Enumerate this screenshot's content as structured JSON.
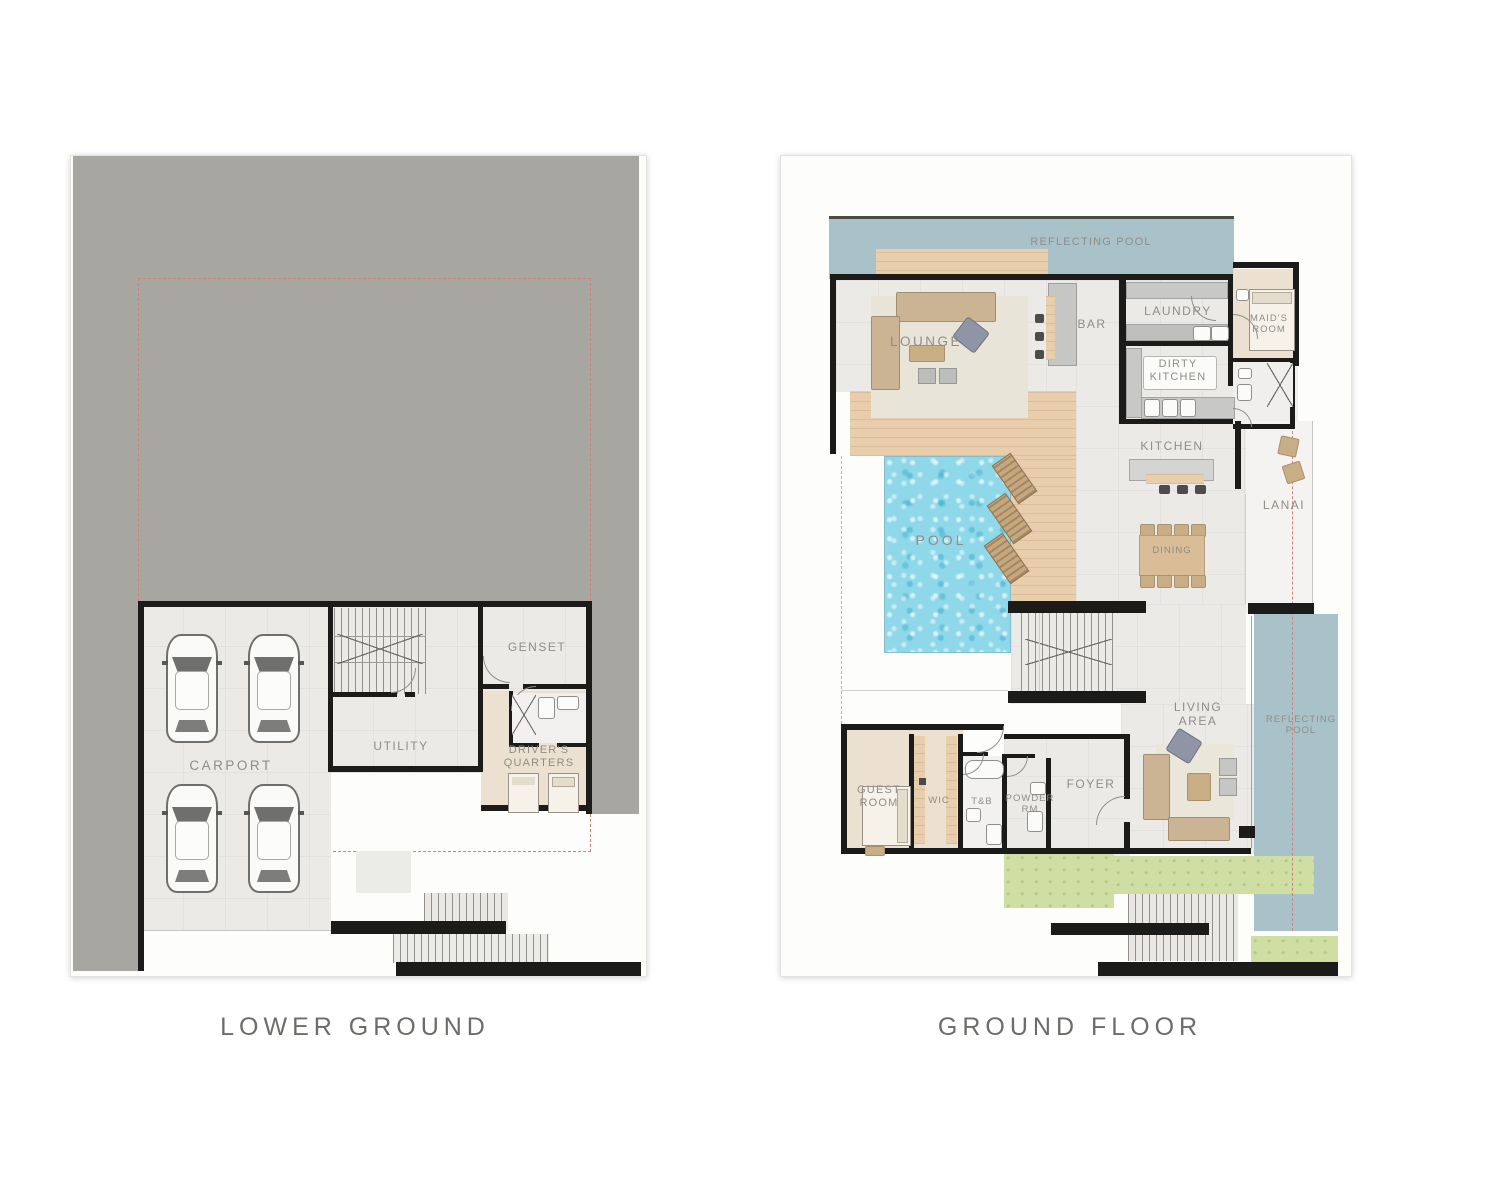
{
  "left_plan": {
    "title": "LOWER GROUND",
    "labels": {
      "carport": "CARPORT",
      "utility": "UTILITY",
      "genset": "GENSET",
      "drivers_quarters": [
        "DRIVER'S",
        "QUARTERS"
      ]
    }
  },
  "right_plan": {
    "title": "GROUND FLOOR",
    "labels": {
      "reflecting_pool_top": "REFLECTING POOL",
      "lounge": "LOUNGE",
      "bar": "BAR",
      "laundry": "LAUNDRY",
      "dirty_kitchen": [
        "DIRTY",
        "KITCHEN"
      ],
      "maids_room": [
        "MAID'S",
        "ROOM"
      ],
      "kitchen": "KITCHEN",
      "lanai": "LANAI",
      "pool": "POOL",
      "dining": "DINING",
      "living_area": [
        "LIVING",
        "AREA"
      ],
      "reflecting_pool_side": [
        "REFLECTING",
        "POOL"
      ],
      "guest_room": [
        "GUEST",
        "ROOM"
      ],
      "wic": "WIC",
      "t_and_b": "T&B",
      "powder_rm": [
        "POWDER",
        "RM"
      ],
      "foyer": "FOYER"
    }
  },
  "colors": {
    "site_gray": "#a8a6a0",
    "wall_black": "#1b1b1a",
    "floor_gray": "#ebeae7",
    "wood": "#e8ceac",
    "beige": "#ece1d0",
    "pool_water": "#8fd8ea",
    "reflecting_pool": "#a9c2ca",
    "grass": "#cfdfa4",
    "property_line_red": "#c9837b",
    "label_gray": "#8f8d87",
    "title_gray": "#6e6c68"
  }
}
